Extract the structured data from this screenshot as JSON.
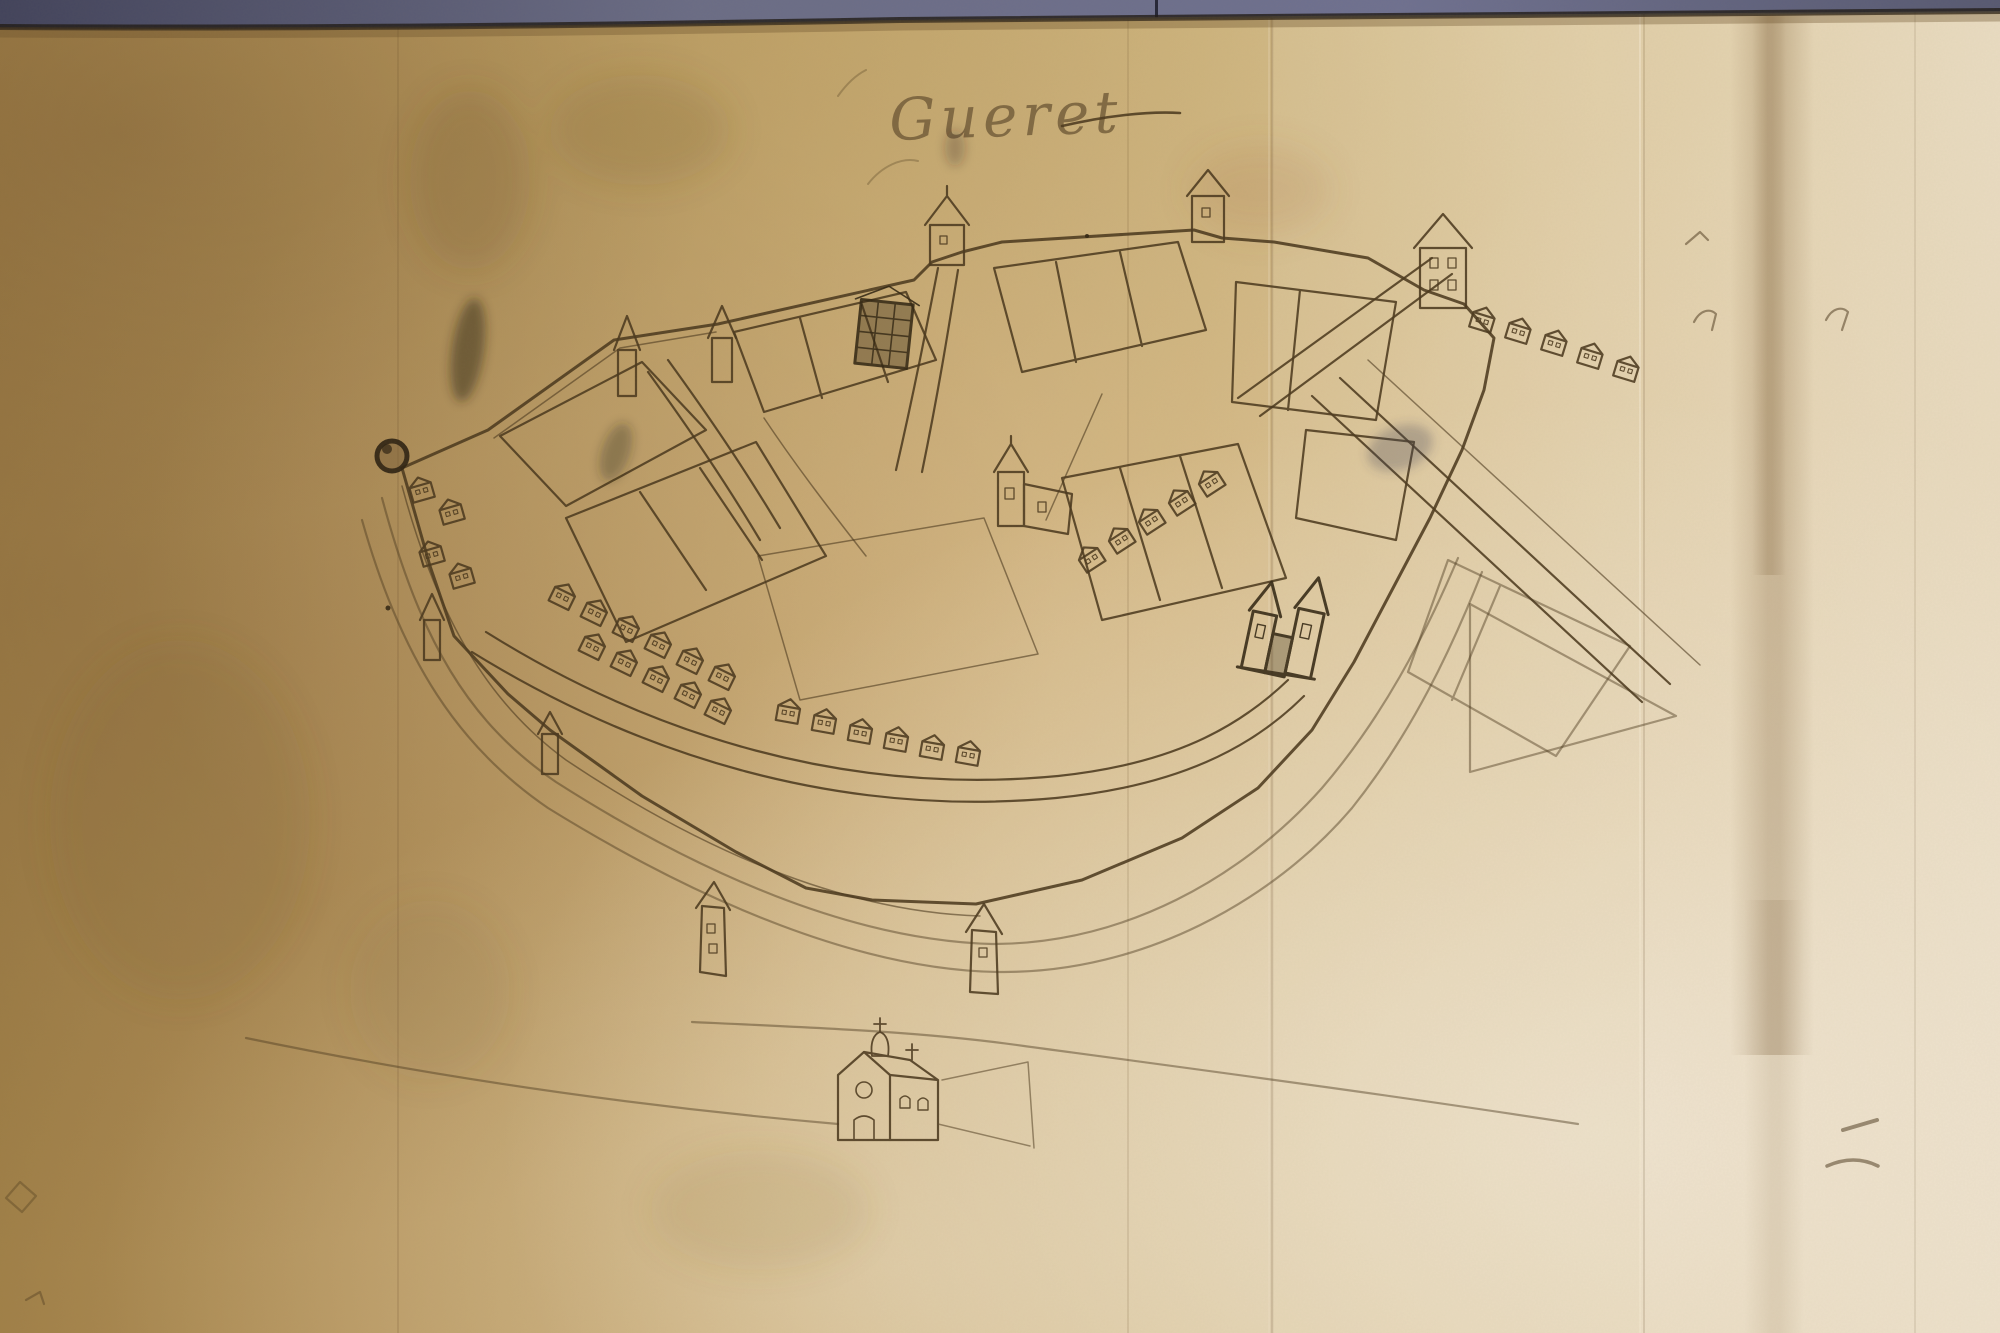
{
  "artifact": {
    "type": "photograph of a hand-drawn manuscript town map",
    "medium": "brown ink on aged parchment",
    "subject": "bird's-eye plan of the walled town of Gueret",
    "condition": "creased, stained and foxed parchment, darker at left, pale at lower right"
  },
  "map": {
    "title": "Gueret",
    "title_style": "handwritten cursive ink inscription with trailing flourish",
    "features": [
      {
        "name": "town-wall",
        "kind": "fortified enceinte enclosing the town"
      },
      {
        "name": "town-ditch",
        "kind": "concentric ditch lines outside the wall"
      },
      {
        "name": "round-tower",
        "kind": "round corner tower, west angle"
      },
      {
        "name": "gate-tower",
        "kind": "square gate tower with pyramidal spire, north wall"
      },
      {
        "name": "wall-tower",
        "kind": "square wall towers with pointed roofs"
      },
      {
        "name": "spire-turret",
        "kind": "slender turrets with conical spires"
      },
      {
        "name": "bastion-turret",
        "kind": "small turrets on the southern outworks"
      },
      {
        "name": "market-square",
        "kind": "open central square"
      },
      {
        "name": "house-row",
        "kind": "rows of gabled houses with windows along streets"
      },
      {
        "name": "dark-building",
        "kind": "large multi-storey building drawn in heavy ink"
      },
      {
        "name": "parish-church",
        "kind": "church with steeple inside the walls"
      },
      {
        "name": "twin-spired-church",
        "kind": "church with two spires, east quarter"
      },
      {
        "name": "chapel",
        "kind": "chapel with domed lantern and crosses outside the south wall"
      },
      {
        "name": "street",
        "kind": "curving streets and lanes"
      },
      {
        "name": "country-road",
        "kind": "parallel roads leaving town to the south-east"
      },
      {
        "name": "garden-plots",
        "kind": "field and garden enclosures east of the wall"
      },
      {
        "name": "field-boundary",
        "kind": "long boundary lines across the foreground"
      },
      {
        "name": "ink-smudge",
        "kind": "accidental ink smears"
      },
      {
        "name": "pen-mark",
        "kind": "small pen trials scattered on the margins"
      },
      {
        "name": "fold-crease",
        "kind": "vertical folds and water-stain band in the parchment"
      }
    ]
  },
  "colors": {
    "photo_background": "#6b6d86",
    "photo_background_dark": "#43445c",
    "parchment_dark": "#a08048",
    "parchment_mid": "#cdb077",
    "parchment_light": "#e9dcc2",
    "stain_brown": "#6e4f28",
    "ink": "#4c3a1f",
    "ink_dark": "#332714",
    "title_ink": "#6e5836",
    "edge_shadow": "#201c18"
  }
}
